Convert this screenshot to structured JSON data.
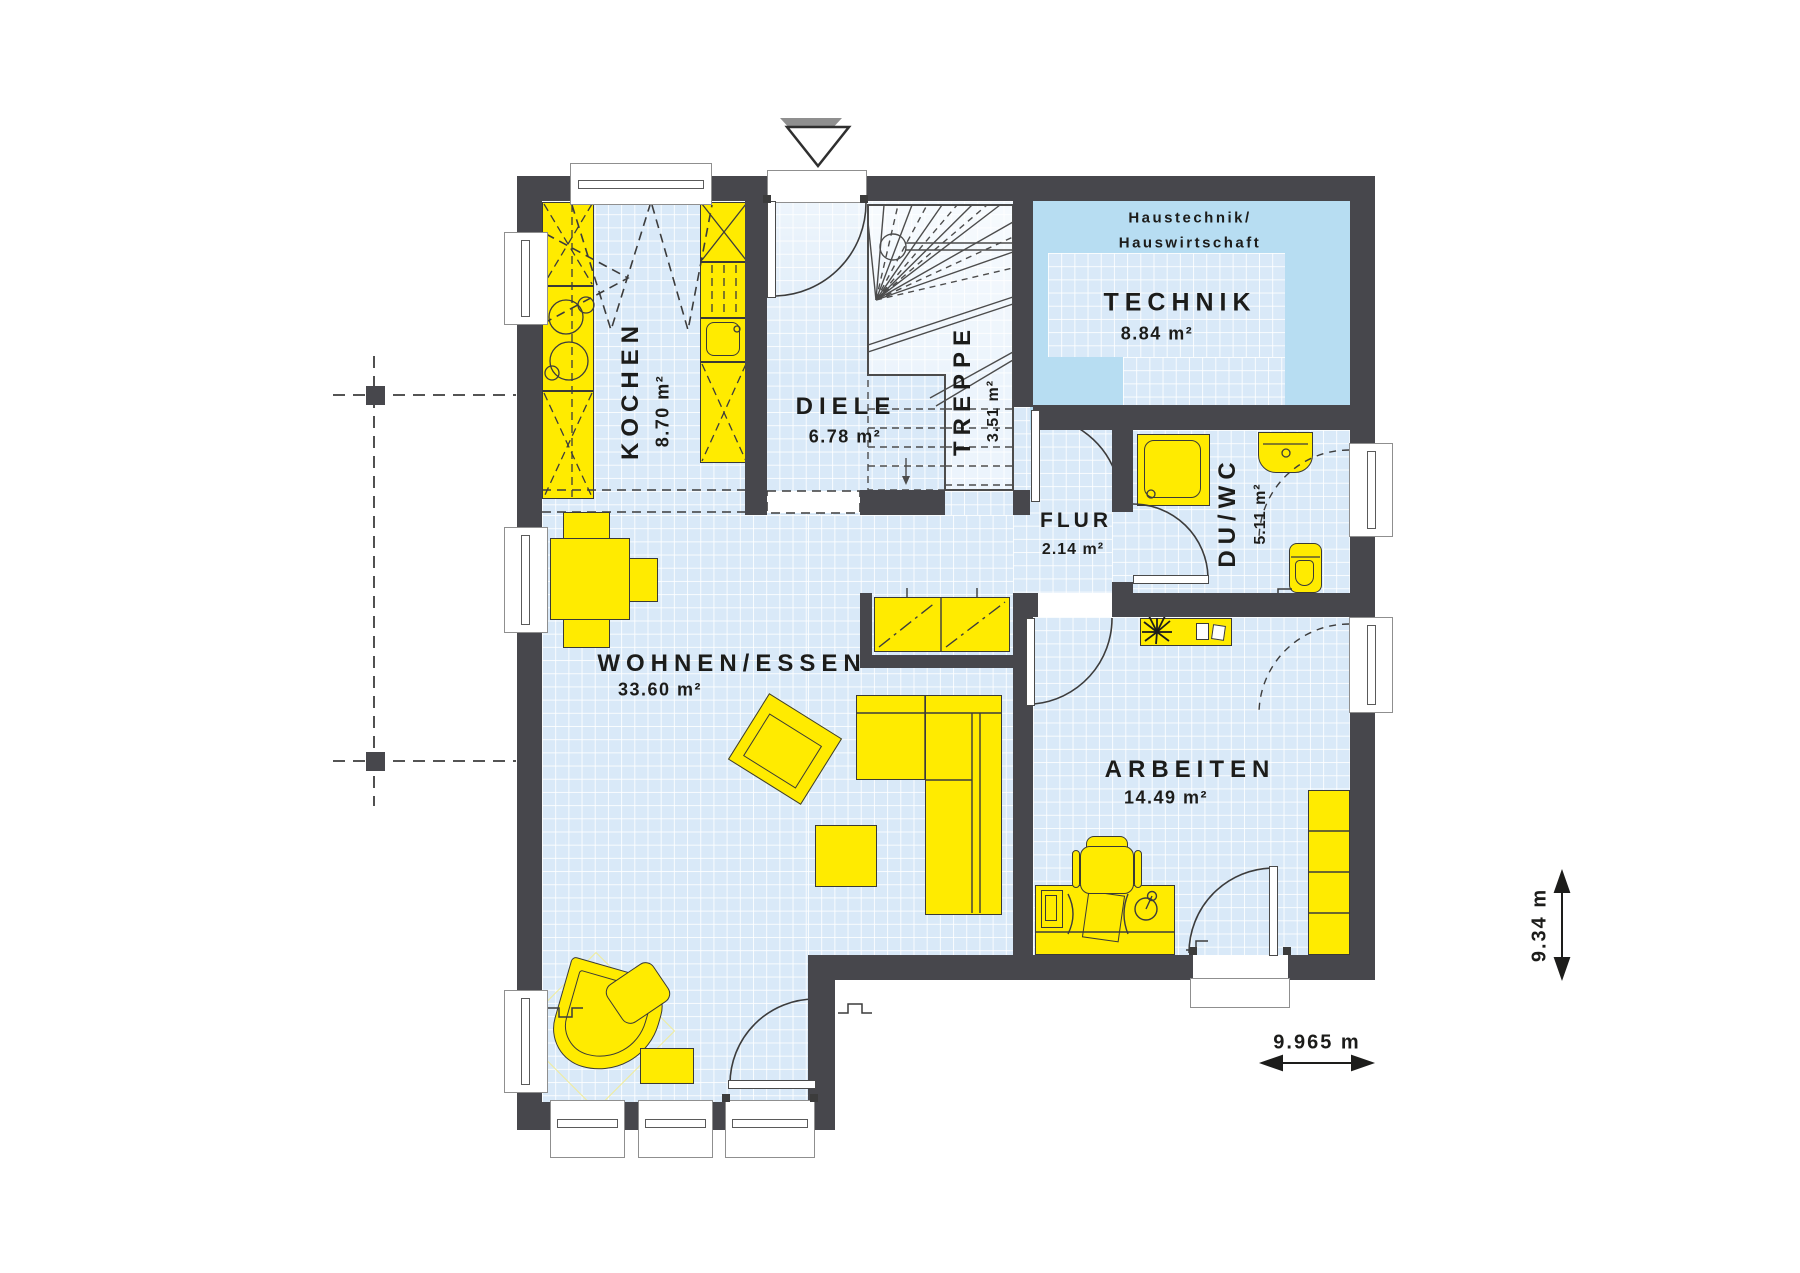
{
  "rooms": {
    "kochen": {
      "name": "KOCHEN",
      "area": "8.70 m²"
    },
    "diele": {
      "name": "DIELE",
      "area": "6.78 m²"
    },
    "treppe": {
      "name": "TREPPE",
      "area": "3.51 m²"
    },
    "technik": {
      "name": "TECHNIK",
      "area": "8.84 m²",
      "note1": "Haustechnik/",
      "note2": "Hauswirtschaft"
    },
    "flur": {
      "name": "FLUR",
      "area": "2.14 m²"
    },
    "du_wc": {
      "name": "DU/WC",
      "area": "5.11 m²"
    },
    "wohnen_essen": {
      "name": "WOHNEN/ESSEN",
      "area": "33.60 m²"
    },
    "arbeiten": {
      "name": "ARBEITEN",
      "area": "14.49 m²"
    }
  },
  "dimensions": {
    "total_width": "9.965 m",
    "total_height": "9.34 m"
  },
  "colors": {
    "wall": "#47474c",
    "floor_tile": "#d9e9f8",
    "technik_zone": "#b7ddf2",
    "furniture": "#ffeb00"
  }
}
